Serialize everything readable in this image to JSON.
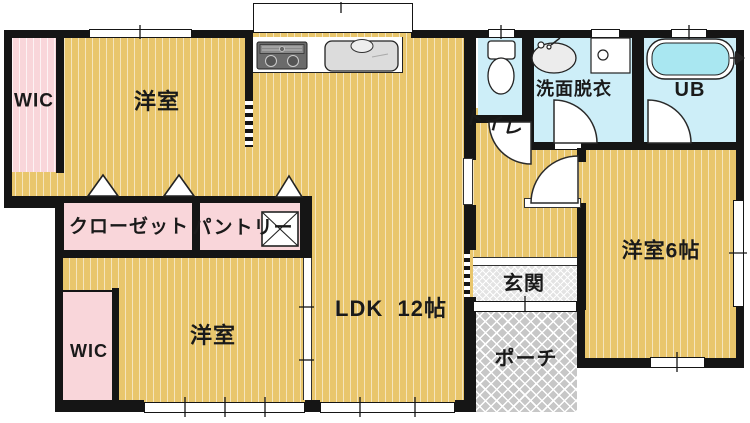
{
  "rooms": {
    "wic_top": {
      "label": "WIC"
    },
    "bedroom_top": {
      "label": "洋室"
    },
    "toilet": {
      "label": "トイレ"
    },
    "washroom": {
      "label": "洗面脱衣"
    },
    "unit_bath": {
      "label": "UB"
    },
    "closet": {
      "label": "クローゼット"
    },
    "pantry": {
      "label": "パントリー"
    },
    "ldk": {
      "label": "LDK  12帖"
    },
    "bedroom_bottom": {
      "label": "洋室"
    },
    "wic_bottom": {
      "label": "WIC"
    },
    "entrance": {
      "label": "玄関"
    },
    "porch": {
      "label": "ポーチ"
    },
    "bedroom_east": {
      "label": "洋室6帖"
    }
  },
  "colors": {
    "floor_wood": "#e9c66c",
    "closet_pink": "#f9d6da",
    "wet_area_cyan": "#cdeef8",
    "bathtub_cyan": "#a9e7f1",
    "wall_black": "#151515",
    "entrance_gray": "#e3e3e3",
    "porch_gray": "#c7c7c7"
  },
  "fixtures": [
    "stove-icon",
    "kitchen-sink-icon",
    "toilet-icon",
    "washbasin-icon",
    "washing-machine-icon",
    "bathtub-icon",
    "floor-hatch-icon"
  ]
}
